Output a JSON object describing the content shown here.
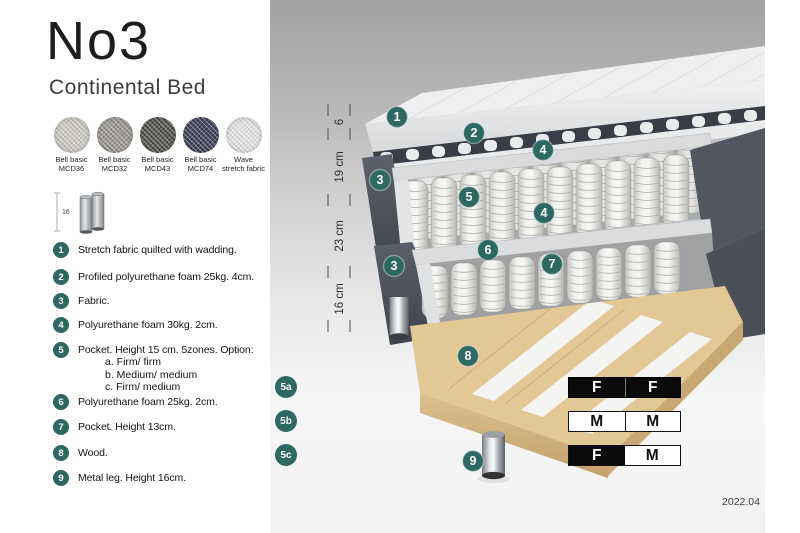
{
  "header": {
    "title": "No3",
    "subtitle": "Continental Bed"
  },
  "swatches": [
    {
      "line1": "Bell basic",
      "line2": "MCD36"
    },
    {
      "line1": "Bell basic",
      "line2": "MCD32"
    },
    {
      "line1": "Bell basic",
      "line2": "MCD43"
    },
    {
      "line1": "Bell basic",
      "line2": "MCD74"
    },
    {
      "line1": "Wave",
      "line2": "stretch fabric"
    }
  ],
  "leg_thumbnail": {
    "height_label": "16"
  },
  "legend": {
    "items": [
      {
        "num": "1",
        "text": "Stretch fabric quilted with wadding."
      },
      {
        "num": "2",
        "text": "Profiled polyurethane foam 25kg. 4cm."
      },
      {
        "num": "3",
        "text": "Fabric."
      },
      {
        "num": "4",
        "text": "Polyurethane foam 30kg. 2cm."
      },
      {
        "num": "5",
        "text": "Pocket. Height 15 cm. 5zones. Option:",
        "options": [
          "a. Firm/ firm",
          "b. Medium/ medium",
          "c. Firm/ medium"
        ]
      },
      {
        "num": "6",
        "text": "Polyurethane foam 25kg. 2cm."
      },
      {
        "num": "7",
        "text": "Pocket. Height 13cm."
      },
      {
        "num": "8",
        "text": "Wood."
      },
      {
        "num": "9",
        "text": "Metal leg. Height 16cm."
      }
    ]
  },
  "diagram": {
    "dimensions": [
      {
        "label": "6"
      },
      {
        "label": "19 cm"
      },
      {
        "label": "23 cm"
      },
      {
        "label": "16 cm"
      }
    ],
    "markers": {
      "m1": "1",
      "m2": "2",
      "m3a": "3",
      "m3b": "3",
      "m4a": "4",
      "m4b": "4",
      "m5": "5",
      "m6": "6",
      "m7": "7",
      "m8": "8",
      "m9": "9"
    },
    "version": "2022.04"
  },
  "firmness": {
    "rows": [
      {
        "label": "5a",
        "left": "F",
        "right": "F"
      },
      {
        "label": "5b",
        "left": "M",
        "right": "M"
      },
      {
        "label": "5c",
        "left": "F",
        "right": "M"
      }
    ]
  },
  "colors": {
    "accent_teal": "#2d6862",
    "fabric_dark": "#4d525c",
    "wood": "#ddc293",
    "table_black": "#0a0a0a"
  }
}
